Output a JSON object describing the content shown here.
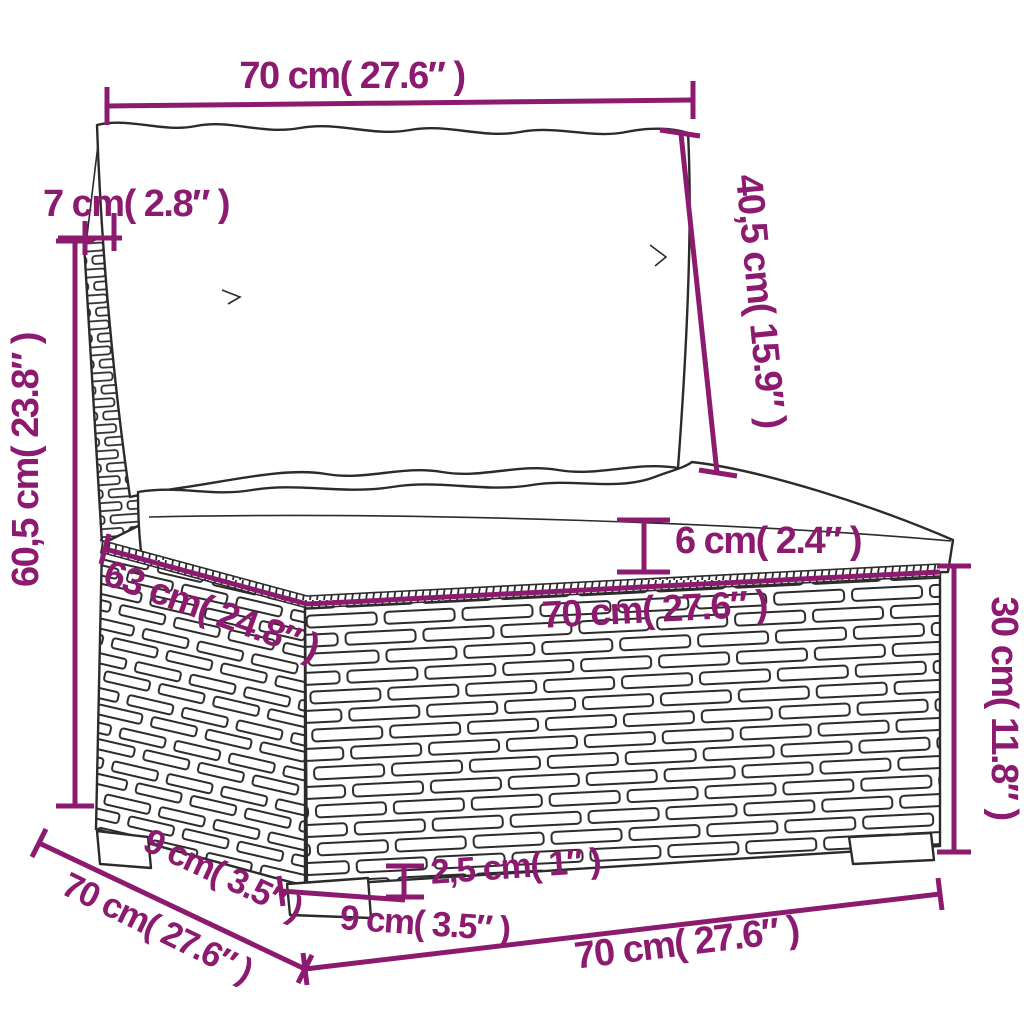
{
  "figure": {
    "kind": "furniture-dimension-diagram",
    "subject": "rattan garden middle sofa with back cushion and seat cushion, line drawing with measurement annotations"
  },
  "colors": {
    "dimension_annotation": "#8c1b70",
    "drawing_outline": "#2b2b2b",
    "background": "#ffffff"
  },
  "dims": {
    "back_cushion_width": {
      "label": "70 cm( 27.6″ )"
    },
    "back_panel_thickness": {
      "label": "7 cm( 2.8″ )"
    },
    "back_cushion_height": {
      "label": "40,5 cm( 15.9″ )"
    },
    "total_height": {
      "label": "60,5 cm( 23.8″ )"
    },
    "seat_cushion_thickness": {
      "label": "6 cm( 2.4″ )"
    },
    "seat_depth": {
      "label": "63 cm( 24.8″ )"
    },
    "seat_width": {
      "label": "70 cm( 27.6″ )"
    },
    "base_height": {
      "label": "30 cm( 11.8″ )"
    },
    "leg_height": {
      "label": "2,5 cm( 1″ )"
    },
    "leg_width": {
      "label": "9 cm( 3.5″ )"
    },
    "leg_depth": {
      "label": "9 cm( 3.5″ )"
    },
    "total_depth": {
      "label": "70 cm( 27.6″ )"
    },
    "total_width": {
      "label": "70 cm( 27.6″ )"
    }
  }
}
